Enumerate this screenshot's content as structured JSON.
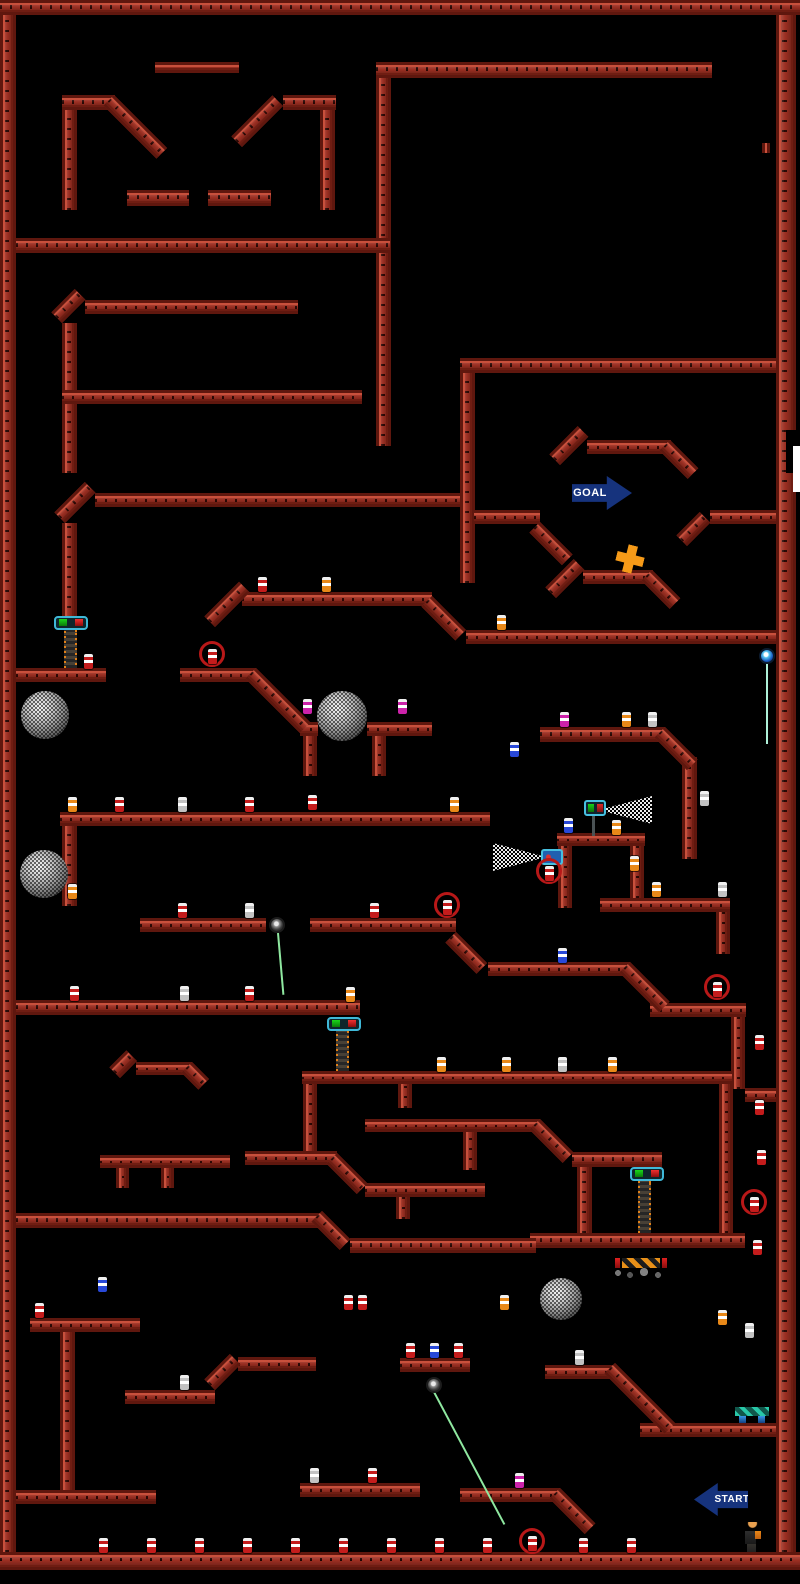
{
  "meta": {
    "title": "platformer-level-map",
    "accent_red": "#9c2f22",
    "background": "#000000"
  },
  "level": {
    "beams": [
      [
        0,
        0,
        800,
        15
      ],
      [
        0,
        15,
        16,
        1537
      ],
      [
        776,
        15,
        20,
        1537
      ],
      [
        0,
        1552,
        800,
        18
      ],
      [
        62,
        95,
        53,
        15
      ],
      [
        62,
        110,
        15,
        100
      ],
      [
        283,
        95,
        53,
        15
      ],
      [
        320,
        110,
        15,
        100
      ],
      [
        127,
        190,
        62,
        16
      ],
      [
        208,
        190,
        63,
        16
      ],
      [
        155,
        62,
        84,
        11
      ],
      [
        376,
        62,
        336,
        16
      ],
      [
        376,
        78,
        15,
        368
      ],
      [
        16,
        238,
        374,
        15
      ],
      [
        85,
        300,
        213,
        14
      ],
      [
        62,
        323,
        15,
        150
      ],
      [
        62,
        390,
        300,
        14
      ],
      [
        460,
        358,
        316,
        15
      ],
      [
        460,
        373,
        15,
        210
      ],
      [
        587,
        440,
        84,
        14
      ],
      [
        474,
        510,
        66,
        14
      ],
      [
        710,
        510,
        66,
        14
      ],
      [
        583,
        570,
        70,
        14
      ],
      [
        95,
        493,
        365,
        14
      ],
      [
        62,
        523,
        15,
        95
      ],
      [
        16,
        668,
        90,
        14
      ],
      [
        180,
        668,
        76,
        14
      ],
      [
        242,
        592,
        190,
        14
      ],
      [
        466,
        630,
        310,
        14
      ],
      [
        300,
        722,
        18,
        14
      ],
      [
        367,
        722,
        65,
        14
      ],
      [
        303,
        736,
        14,
        40
      ],
      [
        372,
        736,
        14,
        40
      ],
      [
        540,
        727,
        125,
        15
      ],
      [
        682,
        757,
        15,
        102
      ],
      [
        557,
        833,
        88,
        13
      ],
      [
        558,
        846,
        14,
        62
      ],
      [
        630,
        846,
        14,
        62
      ],
      [
        600,
        898,
        130,
        14
      ],
      [
        716,
        912,
        14,
        42
      ],
      [
        60,
        812,
        430,
        14
      ],
      [
        62,
        826,
        15,
        80
      ],
      [
        140,
        918,
        126,
        14
      ],
      [
        310,
        918,
        146,
        14
      ],
      [
        488,
        962,
        142,
        14
      ],
      [
        16,
        1000,
        344,
        15
      ],
      [
        650,
        1003,
        96,
        14
      ],
      [
        731,
        1017,
        14,
        72
      ],
      [
        745,
        1088,
        31,
        14
      ],
      [
        302,
        1071,
        430,
        13
      ],
      [
        303,
        1084,
        14,
        71
      ],
      [
        136,
        1062,
        56,
        13
      ],
      [
        100,
        1155,
        130,
        13
      ],
      [
        116,
        1168,
        13,
        20
      ],
      [
        161,
        1168,
        13,
        20
      ],
      [
        245,
        1151,
        92,
        14
      ],
      [
        365,
        1183,
        120,
        14
      ],
      [
        396,
        1197,
        14,
        22
      ],
      [
        365,
        1119,
        175,
        13
      ],
      [
        398,
        1084,
        14,
        24
      ],
      [
        463,
        1132,
        14,
        38
      ],
      [
        572,
        1152,
        90,
        15
      ],
      [
        577,
        1167,
        15,
        66
      ],
      [
        719,
        1084,
        14,
        149
      ],
      [
        530,
        1233,
        215,
        15
      ],
      [
        350,
        1238,
        186,
        15
      ],
      [
        16,
        1213,
        308,
        15
      ],
      [
        30,
        1318,
        110,
        14
      ],
      [
        60,
        1332,
        15,
        160
      ],
      [
        16,
        1490,
        140,
        14
      ],
      [
        125,
        1390,
        90,
        14
      ],
      [
        238,
        1357,
        78,
        14
      ],
      [
        400,
        1358,
        70,
        14
      ],
      [
        545,
        1365,
        70,
        14
      ],
      [
        640,
        1423,
        136,
        14
      ],
      [
        300,
        1483,
        120,
        14
      ],
      [
        460,
        1488,
        100,
        14
      ],
      [
        762,
        143,
        8,
        10
      ]
    ],
    "slopes": [
      [
        114,
        95,
        75,
        45
      ],
      [
        242,
        147,
        58,
        -45
      ],
      [
        62,
        323,
        33,
        -45
      ],
      [
        560,
        465,
        40,
        -45
      ],
      [
        670,
        440,
        40,
        45
      ],
      [
        540,
        522,
        46,
        45
      ],
      [
        687,
        546,
        33,
        -45
      ],
      [
        556,
        598,
        40,
        -45
      ],
      [
        652,
        570,
        40,
        45
      ],
      [
        65,
        523,
        43,
        -45
      ],
      [
        256,
        668,
        77,
        45
      ],
      [
        215,
        627,
        49,
        -45
      ],
      [
        432,
        596,
        48,
        45
      ],
      [
        456,
        932,
        44,
        45
      ],
      [
        630,
        962,
        56,
        45
      ],
      [
        337,
        1153,
        43,
        45
      ],
      [
        540,
        1119,
        47,
        45
      ],
      [
        322,
        1211,
        40,
        45
      ],
      [
        120,
        1078,
        24,
        -45
      ],
      [
        192,
        1062,
        24,
        45
      ],
      [
        215,
        1390,
        36,
        -45
      ],
      [
        615,
        1363,
        85,
        45
      ],
      [
        560,
        1488,
        50,
        45
      ],
      [
        665,
        727,
        46,
        45
      ]
    ],
    "spheres": [
      [
        21,
        691,
        48
      ],
      [
        20,
        850,
        48
      ],
      [
        317,
        691,
        50
      ],
      [
        540,
        1278,
        42
      ]
    ],
    "chains": [
      {
        "head": [
          54,
          616
        ],
        "chain": [
          64,
          630,
          38
        ]
      },
      {
        "head": [
          327,
          1017
        ],
        "chain": [
          336,
          1031,
          40
        ]
      },
      {
        "head": [
          630,
          1167
        ],
        "chain": [
          638,
          1181,
          52
        ]
      }
    ],
    "eyes": [
      {
        "x": 269,
        "y": 917,
        "color": "dark",
        "laser": {
          "x": 277,
          "y": 933,
          "len": 62,
          "angle": -5
        }
      },
      {
        "x": 759,
        "y": 648,
        "color": "blue",
        "laser": {
          "x": 766,
          "y": 664,
          "len": 80,
          "angle": 0
        }
      },
      {
        "x": 426,
        "y": 1377,
        "color": "dark",
        "laser": {
          "x": 433,
          "y": 1392,
          "len": 150,
          "angle": -28
        }
      }
    ],
    "turrets": [
      {
        "x": 584,
        "y": 800,
        "variant": "g",
        "cone": "right",
        "cone_box": [
          604,
          796,
          48,
          28
        ],
        "pole": [
          592,
          816,
          3,
          20
        ]
      },
      {
        "x": 541,
        "y": 849,
        "variant": "b",
        "cone": "left",
        "cone_box": [
          493,
          843,
          48,
          28
        ]
      }
    ],
    "rings": [
      [
        199,
        641
      ],
      [
        536,
        858
      ],
      [
        434,
        892
      ],
      [
        704,
        974
      ],
      [
        741,
        1189
      ],
      [
        519,
        1528
      ]
    ],
    "bottles": [
      [
        84,
        654,
        "red"
      ],
      [
        208,
        649,
        "red"
      ],
      [
        258,
        577,
        "red"
      ],
      [
        322,
        577,
        "orange"
      ],
      [
        497,
        615,
        "orange"
      ],
      [
        303,
        699,
        "magenta"
      ],
      [
        398,
        699,
        "magenta"
      ],
      [
        560,
        712,
        "magenta"
      ],
      [
        622,
        712,
        "orange"
      ],
      [
        648,
        712,
        "white"
      ],
      [
        700,
        791,
        "white"
      ],
      [
        510,
        742,
        "blue"
      ],
      [
        68,
        797,
        "orange"
      ],
      [
        115,
        797,
        "red"
      ],
      [
        178,
        797,
        "white"
      ],
      [
        245,
        797,
        "red"
      ],
      [
        308,
        795,
        "red"
      ],
      [
        450,
        797,
        "orange"
      ],
      [
        564,
        818,
        "blue"
      ],
      [
        612,
        820,
        "orange"
      ],
      [
        545,
        866,
        "red"
      ],
      [
        630,
        856,
        "orange"
      ],
      [
        652,
        882,
        "orange"
      ],
      [
        718,
        882,
        "white"
      ],
      [
        68,
        884,
        "orange"
      ],
      [
        178,
        903,
        "red"
      ],
      [
        245,
        903,
        "white"
      ],
      [
        370,
        903,
        "red"
      ],
      [
        443,
        900,
        "red"
      ],
      [
        558,
        948,
        "blue"
      ],
      [
        70,
        986,
        "red"
      ],
      [
        180,
        986,
        "white"
      ],
      [
        245,
        986,
        "red"
      ],
      [
        346,
        987,
        "orange"
      ],
      [
        713,
        982,
        "red"
      ],
      [
        755,
        1035,
        "red"
      ],
      [
        437,
        1057,
        "orange"
      ],
      [
        502,
        1057,
        "orange"
      ],
      [
        558,
        1057,
        "white"
      ],
      [
        608,
        1057,
        "orange"
      ],
      [
        755,
        1100,
        "red"
      ],
      [
        757,
        1150,
        "red"
      ],
      [
        750,
        1197,
        "red"
      ],
      [
        753,
        1240,
        "red"
      ],
      [
        98,
        1277,
        "blue"
      ],
      [
        35,
        1303,
        "red"
      ],
      [
        344,
        1295,
        "red"
      ],
      [
        358,
        1295,
        "red"
      ],
      [
        500,
        1295,
        "orange"
      ],
      [
        718,
        1310,
        "orange"
      ],
      [
        745,
        1323,
        "white"
      ],
      [
        180,
        1375,
        "white"
      ],
      [
        406,
        1343,
        "red"
      ],
      [
        430,
        1343,
        "blue"
      ],
      [
        454,
        1343,
        "red"
      ],
      [
        575,
        1350,
        "white"
      ],
      [
        310,
        1468,
        "white"
      ],
      [
        368,
        1468,
        "red"
      ],
      [
        515,
        1473,
        "magenta"
      ],
      [
        99,
        1538,
        "red"
      ],
      [
        147,
        1538,
        "red"
      ],
      [
        195,
        1538,
        "red"
      ],
      [
        243,
        1538,
        "red"
      ],
      [
        291,
        1538,
        "red"
      ],
      [
        339,
        1538,
        "red"
      ],
      [
        387,
        1538,
        "red"
      ],
      [
        435,
        1538,
        "red"
      ],
      [
        483,
        1538,
        "red"
      ],
      [
        528,
        1536,
        "red"
      ],
      [
        579,
        1538,
        "red"
      ],
      [
        627,
        1538,
        "red"
      ]
    ],
    "signs": [
      {
        "label": "GOAL",
        "dir": "right",
        "x": 572,
        "y": 476,
        "w": 60,
        "h": 34,
        "color": "#16337d"
      },
      {
        "label": "START",
        "dir": "left",
        "x": 694,
        "y": 1483,
        "w": 54,
        "h": 33,
        "color": "#16337d"
      }
    ],
    "cross": {
      "x": 616,
      "y": 545,
      "color": "#f59a18"
    },
    "barrier": {
      "x": 615,
      "y": 1258,
      "w": 52,
      "h": 10
    },
    "rubble": {
      "x": 610,
      "y": 1267,
      "w": 62,
      "h": 12
    },
    "bench": {
      "x": 735,
      "y": 1407
    },
    "player": {
      "x": 744,
      "y": 1522
    },
    "patches": {
      "black": [
        [
          786,
          430,
          14,
          43
        ]
      ],
      "white": [
        [
          793,
          446,
          7,
          46
        ]
      ]
    }
  }
}
